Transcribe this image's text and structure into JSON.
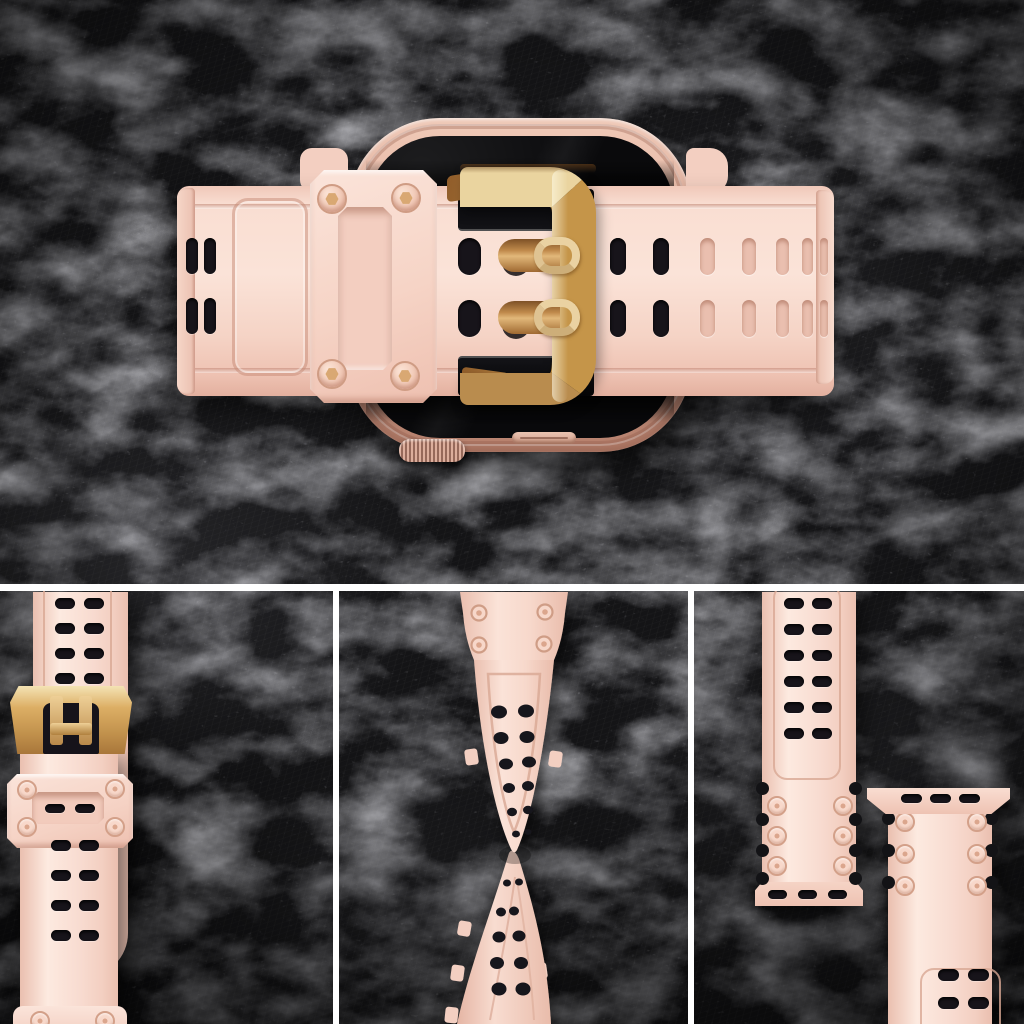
{
  "meta": {
    "type": "product-photo-collage",
    "subject": "Smartwatch with pink rugged silicone band, rose-gold buckle and rivet screws, photographed on black slate; one hero top view and three close-up detail panels below",
    "sections": [
      "hero-top-view",
      "detail-tail-and-buckle",
      "detail-twisted-strap",
      "detail-lug-connectors"
    ]
  },
  "colors": {
    "bg": "#17171a",
    "bg-deep": "#0b0b0d",
    "divider": "#ffffff",
    "pink-light": "#fdeae0",
    "pink-main": "#f8dbd0",
    "pink-mid": "#f3cfc1",
    "pink-shadow": "#eabfaf",
    "pink-deep": "#dfa896",
    "outline-pink": "#d8a794",
    "hole-dark": "#17141a",
    "gold-light": "#f1dfae",
    "gold-mid": "#cf9f55",
    "gold-deep": "#a06a32",
    "gold-dark": "#6e4720",
    "bronze": "#b5803f",
    "case-light": "#f0cab8",
    "case-mid": "#e0ac99",
    "case-deep": "#c08a76",
    "screen": "#0a0a0c",
    "screw-ring": "#d3a089",
    "screw-face": "#f8d8ca",
    "screw-hex": "#d9a873"
  },
  "hero": {
    "watch": {
      "parts": [
        "case",
        "screen",
        "digital-crown",
        "side-button"
      ]
    },
    "band": {
      "keeper_screws": 4,
      "buckle_prongs": 2,
      "tail_holes": {
        "rows": 2,
        "cols": 2
      },
      "frame_holes": {
        "rows": 2,
        "cols": 1
      },
      "right_hole_columns": 7
    }
  },
  "panels": {
    "tail": {
      "strap_a_holes": {
        "rows": 12,
        "cols": 2
      },
      "strap_b": {
        "keeper_rivets": 4,
        "keeper_slots": {
          "rows": 1,
          "cols": 2
        },
        "holes": {
          "rows": 4,
          "cols": 2
        },
        "bottom_rivets": 2
      }
    },
    "twist": {
      "connector_rivets": 4,
      "upper_hole_pairs": 6,
      "lower_hole_pairs": 5
    },
    "lugs": {
      "left": {
        "holes": {
          "rows": 6,
          "cols": 2
        },
        "rivets": 6,
        "lug_slots": {
          "rows": 1,
          "cols": 3
        }
      },
      "right": {
        "holes": {
          "rows": 3,
          "cols": 2
        },
        "rivets": 6,
        "lug_slots": {
          "rows": 1,
          "cols": 3
        }
      }
    }
  }
}
